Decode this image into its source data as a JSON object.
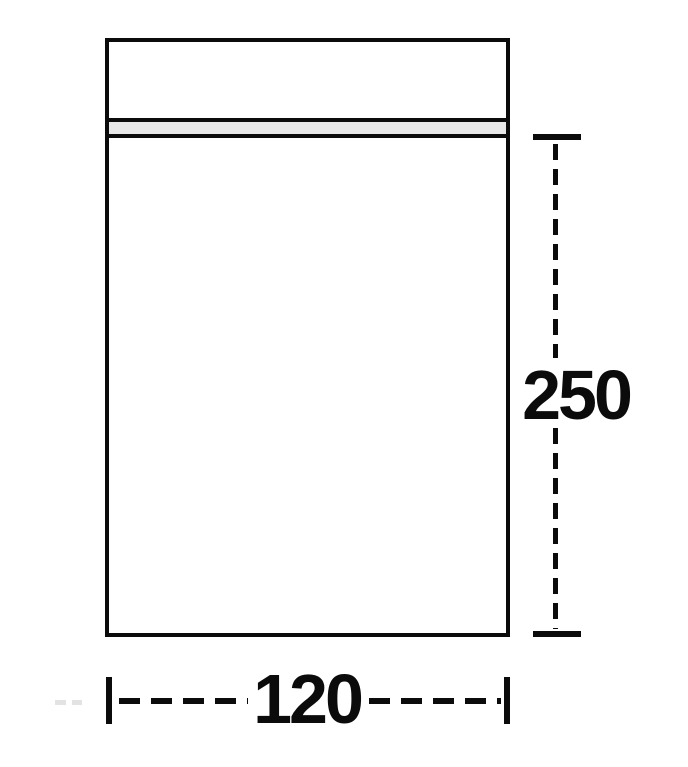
{
  "diagram": {
    "kind": "dimensional-drawing",
    "dimensions": {
      "height_label": "250",
      "width_label": "120"
    },
    "colors": {
      "line": "#0b0b0b",
      "zipper_fill": "#e8e8e8",
      "background": "#ffffff",
      "watermark_dash": "#e3e3e3"
    }
  }
}
